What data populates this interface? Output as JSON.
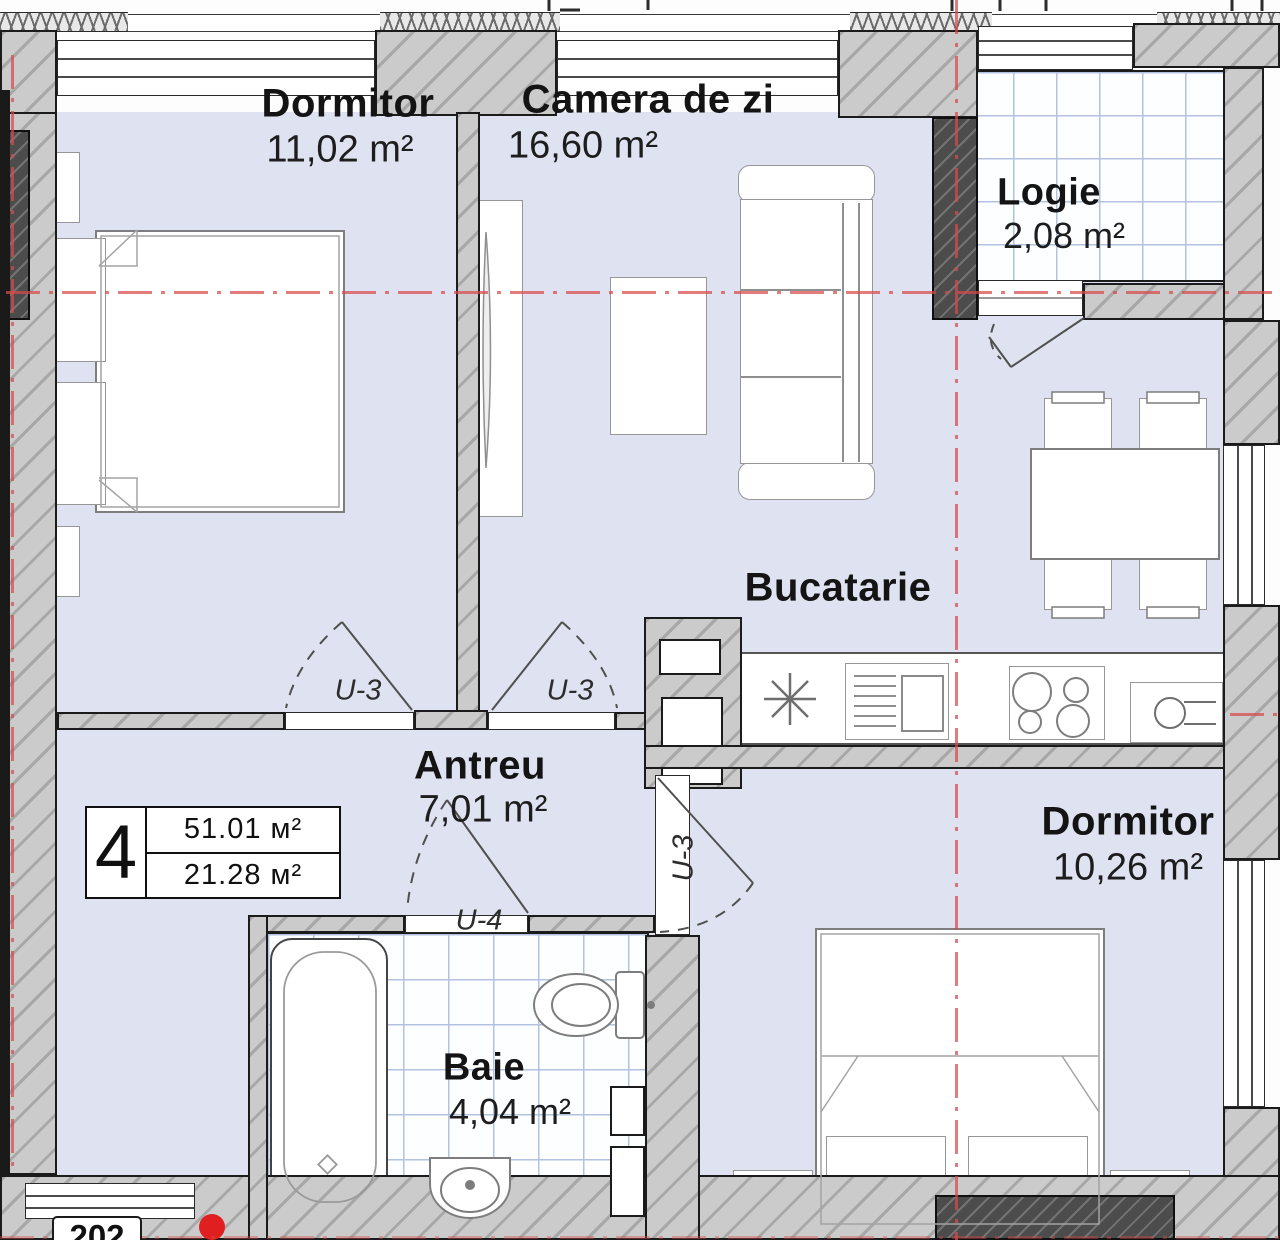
{
  "unit_badge": {
    "number": "4",
    "total_area": "51.01 м²",
    "second_area": "21.28 м²"
  },
  "rooms": {
    "dormitor1": {
      "name": "Dormitor",
      "area": "11,02 m²"
    },
    "camera_de_zi": {
      "name": "Camera de zi",
      "area": "16,60 m²"
    },
    "logie": {
      "name": "Logie",
      "area": "2,08 m²"
    },
    "bucatarie": {
      "name": "Bucatarie"
    },
    "antreu": {
      "name": "Antreu",
      "area": "7,01 m²"
    },
    "dormitor2": {
      "name": "Dormitor",
      "area": "10,26 m²"
    },
    "baie": {
      "name": "Baie",
      "area": "4,04 m²"
    }
  },
  "doors": {
    "bedroom1": "U-3",
    "living": "U-3",
    "bedroom2": "U-3",
    "bath": "U-4"
  },
  "adjacent_unit": "202",
  "colors": {
    "floor": "#dfe2f0",
    "wall": "#cbcbcb",
    "wall_dark": "#4c4c4c",
    "axis_red": "#d84a4a",
    "tile_grid": "#b3c2e0"
  }
}
